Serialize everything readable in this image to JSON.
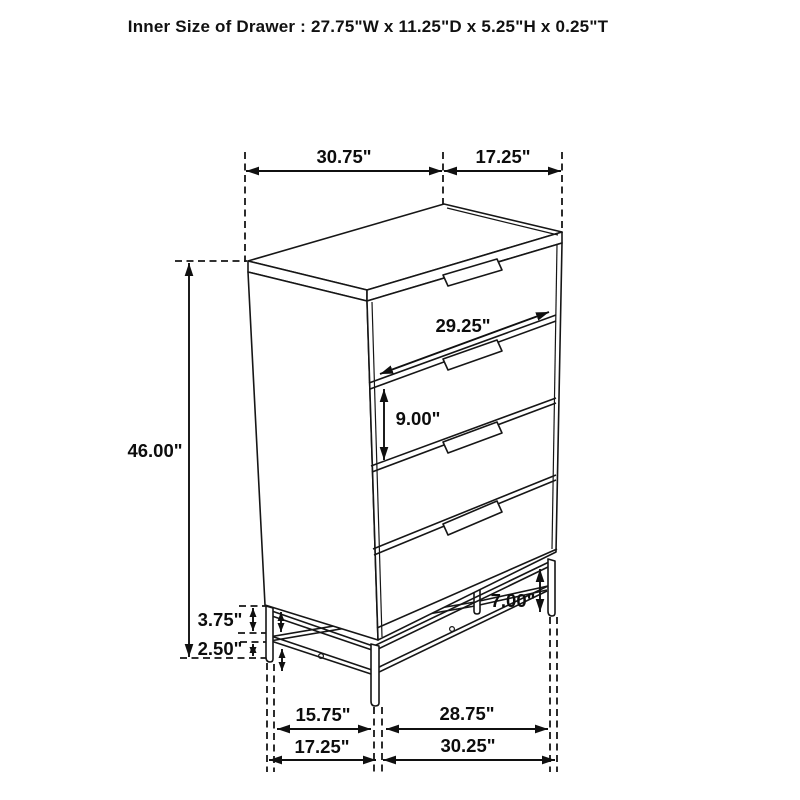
{
  "title": "Inner Size of Drawer : 27.75\"W x 11.25\"D x 5.25\"H x 0.25\"T",
  "diagram": "4-drawer chest with metal base, dimensioned line drawing",
  "colors": {
    "line": "#161616",
    "background": "#ffffff",
    "text": "#0d0d0d"
  },
  "dims": {
    "top_width": "30.75\"",
    "top_depth": "17.25\"",
    "height": "46.00\"",
    "drawer_width": "29.25\"",
    "drawer_front_height": "9.00\"",
    "frame_top_offset": "3.75\"",
    "foot_height": "2.50\"",
    "clearance": "7.00\"",
    "floor_depth_inner": "15.75\"",
    "floor_width_inner": "28.75\"",
    "floor_depth_outer": "17.25\"",
    "floor_width_outer": "30.25\""
  }
}
